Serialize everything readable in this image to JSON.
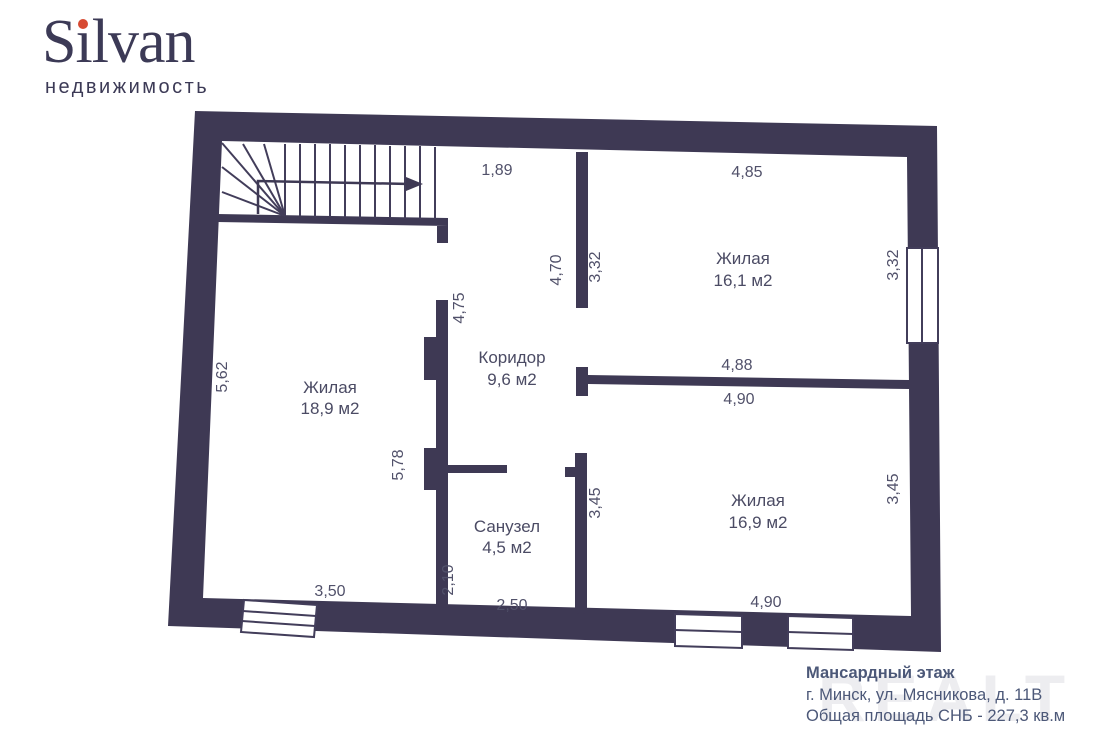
{
  "logo": {
    "brand": "Silvan",
    "brand_prefix": "S",
    "brand_i": "ı",
    "brand_suffix": "lvan",
    "subtitle": "недвижимость"
  },
  "plan": {
    "floor_title": "Мансардный этаж",
    "rooms": [
      {
        "name": "Жилая",
        "area": "18,9 м2"
      },
      {
        "name": "Жилая",
        "area": "16,1 м2"
      },
      {
        "name": "Жилая",
        "area": "16,9 м2"
      },
      {
        "name": "Коридор",
        "area": "9,6 м2"
      },
      {
        "name": "Санузел",
        "area": "4,5 м2"
      }
    ],
    "dimensions": [
      {
        "text": "1,89"
      },
      {
        "text": "4,85"
      },
      {
        "text": "4,70"
      },
      {
        "text": "3,32"
      },
      {
        "text": "3,32"
      },
      {
        "text": "4,75"
      },
      {
        "text": "5,62"
      },
      {
        "text": "4,88"
      },
      {
        "text": "4,90"
      },
      {
        "text": "5,78"
      },
      {
        "text": "3,45"
      },
      {
        "text": "3,45"
      },
      {
        "text": "2,10"
      },
      {
        "text": "2,50"
      },
      {
        "text": "3,50"
      },
      {
        "text": "4,90"
      }
    ]
  },
  "footer": {
    "line1": "Мансардный этаж",
    "line2": "г. Минск, ул. Мясникова, д. 11В",
    "line3": "Общая площадь СНБ - 227,3 кв.м"
  },
  "watermark": "REALT",
  "colors": {
    "wall": "#3e3954",
    "label": "#51516a",
    "footer_text": "#4c5878",
    "logo": "#3c3a56",
    "logo_dot": "#d74a32",
    "watermark": "#ededf0"
  }
}
